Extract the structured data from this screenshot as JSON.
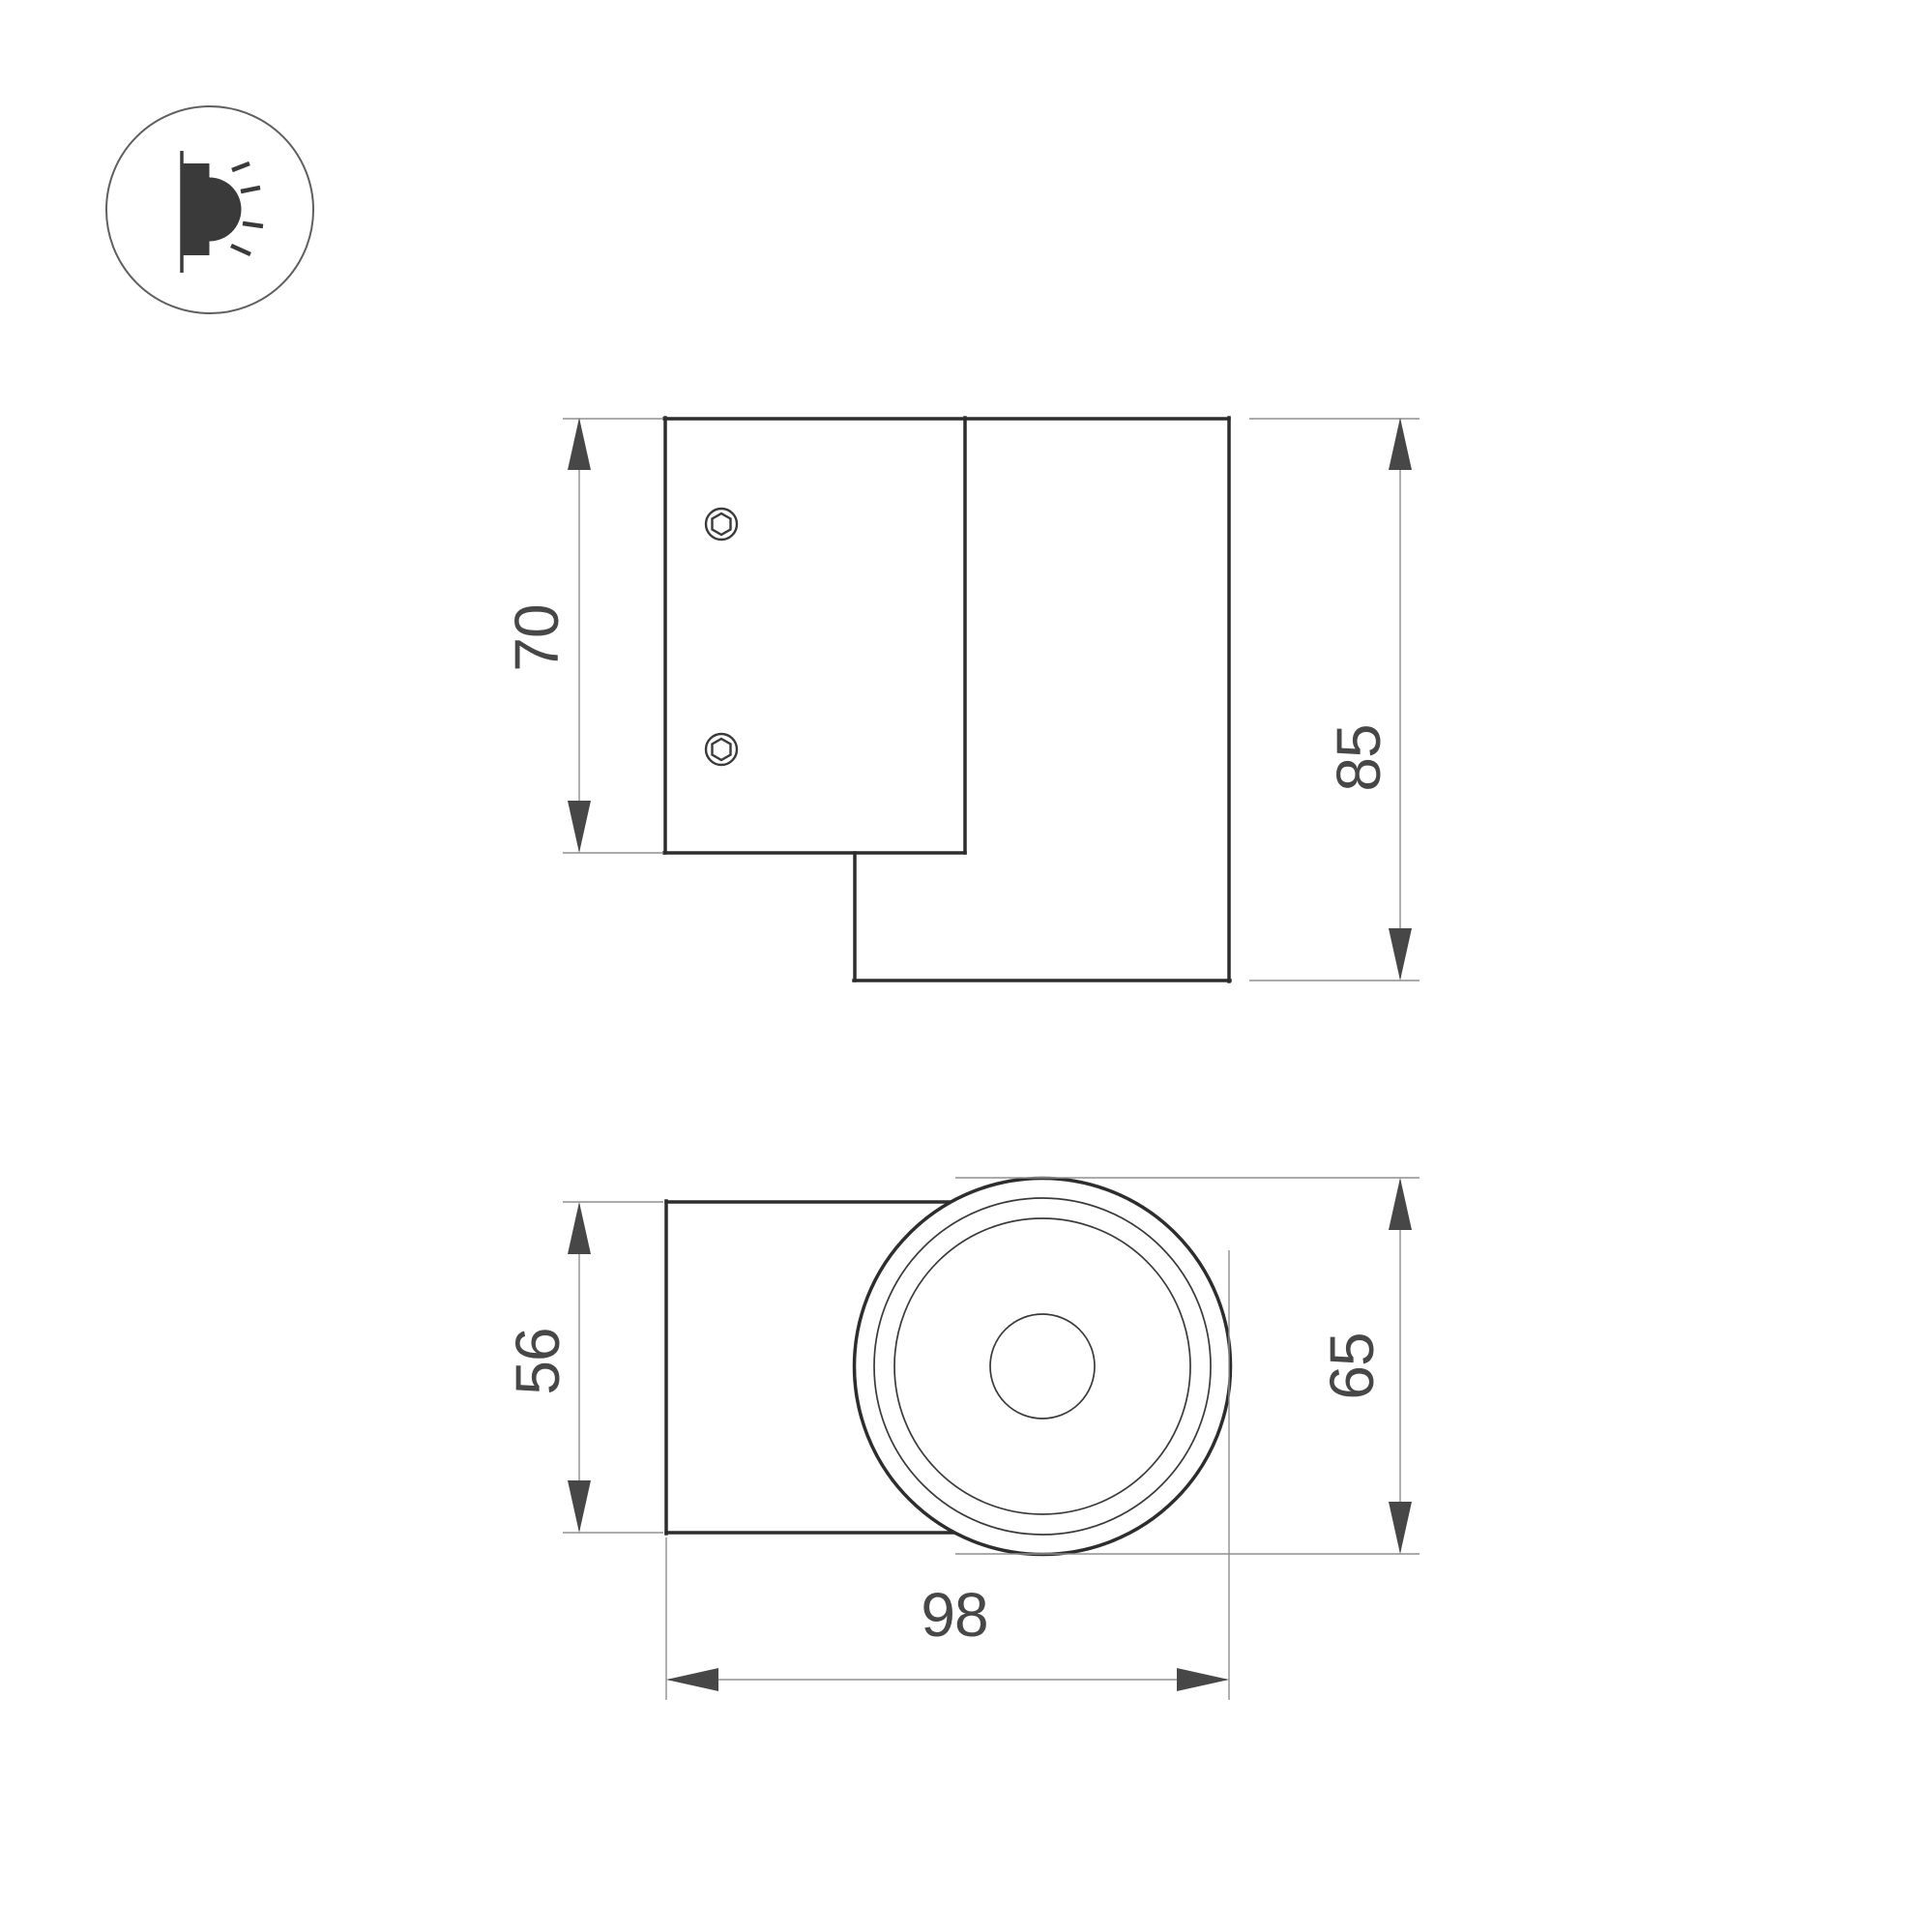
{
  "colors": {
    "bg": "#ffffff",
    "outline": "#2d2d2d",
    "thin-line": "#3a3a3a",
    "dim-line": "#8f8f8f",
    "dim-text": "#474747",
    "icon-fg": "#3a3a3a",
    "icon-ring": "#5f5f5f"
  },
  "icon": {
    "name": "wall-light-icon"
  },
  "side_view": {
    "plate_height_label": "70",
    "overall_height_label": "85"
  },
  "bottom_view": {
    "body_width_label": "56",
    "face_diameter_label": "65",
    "overall_depth_label": "98"
  }
}
